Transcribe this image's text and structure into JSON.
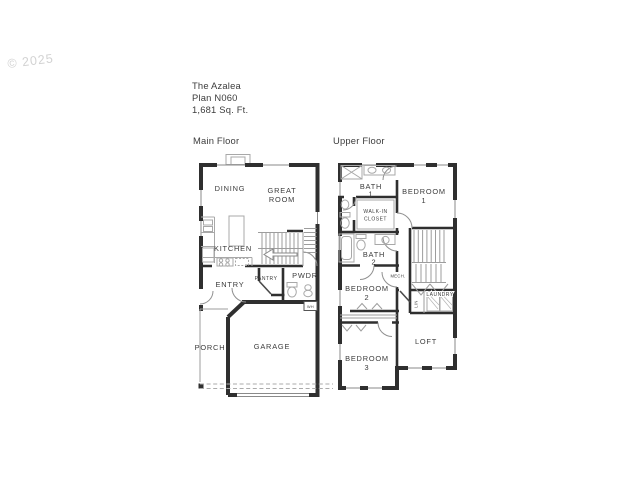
{
  "watermark": "© 2025",
  "header": {
    "title": "The Azalea",
    "plan": "Plan N060",
    "sqft": "1,681 Sq. Ft."
  },
  "main": {
    "label": "Main Floor",
    "dining": "DINING",
    "great1": "GREAT",
    "great2": "ROOM",
    "kitchen": "KITCHEN",
    "entry": "ENTRY",
    "pantry": "PANTRY",
    "pwdr": "PWDR",
    "wh": "WH",
    "garage": "GARAGE",
    "porch": "PORCH"
  },
  "upper": {
    "label": "Upper Floor",
    "bath1a": "BATH",
    "bath1b": "1",
    "bed1a": "BEDROOM",
    "bed1b": "1",
    "closet1": "WALK-IN",
    "closet2": "CLOSET",
    "bath2a": "BATH",
    "bath2b": "2",
    "bed2a": "BEDROOM",
    "bed2b": "2",
    "mech": "MECH.",
    "laundry": "LAUNDRY",
    "lin": "LIN",
    "bed3a": "BEDROOM",
    "bed3b": "3",
    "loft": "LOFT"
  },
  "colors": {
    "wall": "#2f2f2f",
    "text": "#3c3c3c",
    "fixture": "#a8a8a8",
    "watermark": "#d2d2d2",
    "background": "#ffffff"
  }
}
